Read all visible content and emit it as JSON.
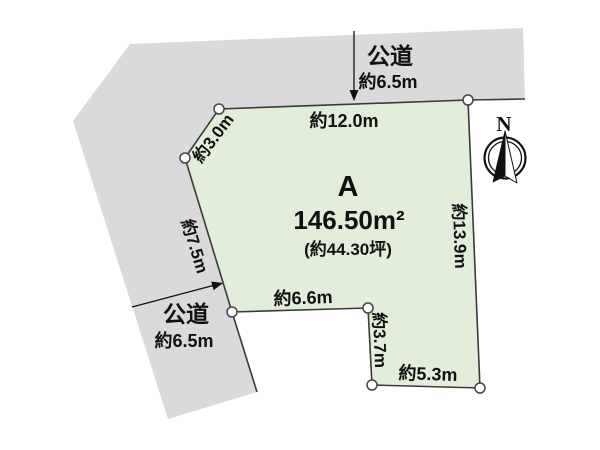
{
  "colors": {
    "parcel_fill": "#e3eeda",
    "road_fill": "#dadadc",
    "line": "#3a3a3a"
  },
  "parcel": {
    "label": "A",
    "area_m2": "146.50m²",
    "area_tsubo": "(約44.30坪)"
  },
  "dimensions": {
    "top": "約12.0m",
    "top_left": "約3.0m",
    "left": "約7.5m",
    "bottom_left": "約6.6m",
    "notch": "約3.7m",
    "bottom": "約5.3m",
    "right": "約13.9m"
  },
  "roads": {
    "top": {
      "name": "公道",
      "width": "約6.5m"
    },
    "left": {
      "name": "公道",
      "width": "約6.5m"
    }
  },
  "compass": {
    "north_label": "N"
  }
}
